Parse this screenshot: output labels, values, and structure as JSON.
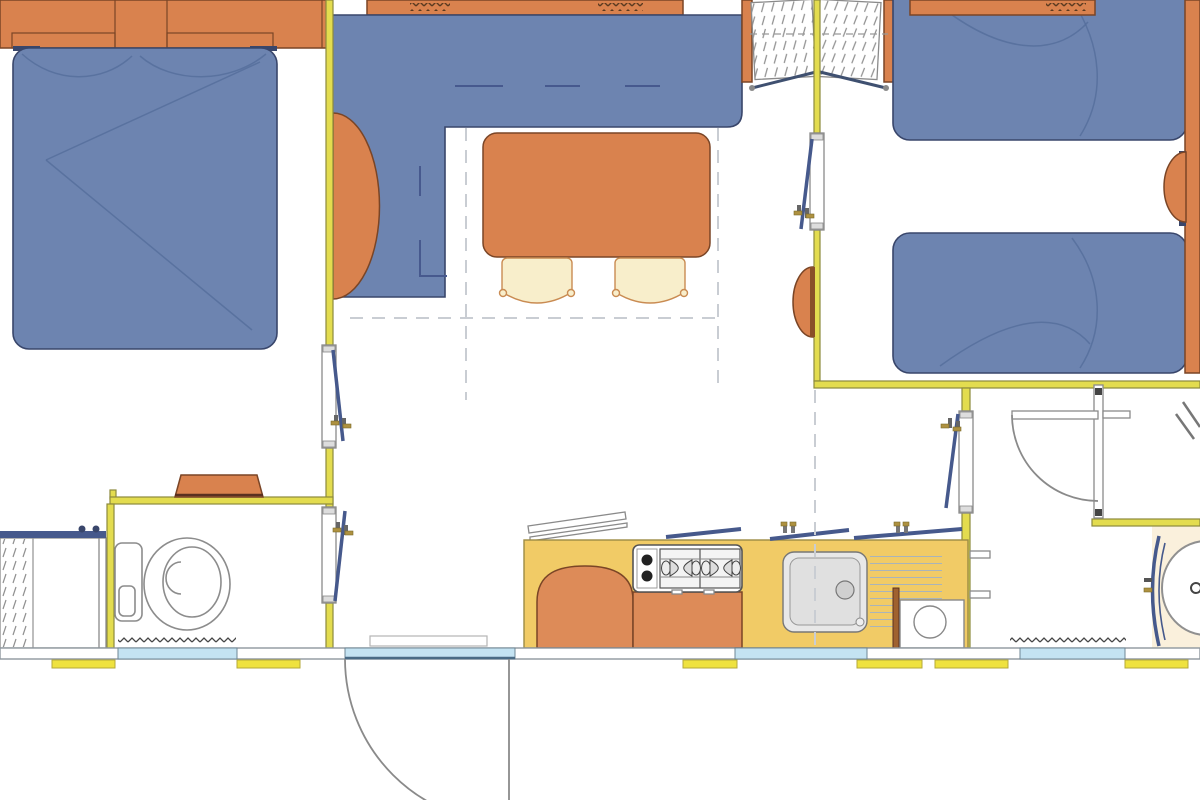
{
  "document": {
    "type": "floor-plan",
    "subject": "mobile-home interior layout, top-down architectural drawing",
    "visible_text": []
  },
  "colors": {
    "bg": "#FFFFFF",
    "wall": "#E3DC4F",
    "wall-edge": "#8D8A3C",
    "blue": "#6D84B0",
    "blue-edge": "#39466B",
    "crease": "#566E9C",
    "orange": "#D9824E",
    "orange-edge": "#7A4526",
    "korange": "#DD8B58",
    "counter": "#F1CB66",
    "counter-edge": "#9C8B45",
    "cream": "#FAF0DC",
    "glass": "#C4E3F2",
    "glass-edge": "#6F8795",
    "sill": "#EFE23F",
    "sill-edge": "#B5A93A",
    "sash": "#46598C",
    "brass": "#AE9140",
    "dash": "#C9CDD3",
    "gray": "#8E979E",
    "fixture": "#8C8C8C",
    "chair": "#F8EECB",
    "chair-edge": "#C98B52",
    "wood": "#A0622F"
  },
  "rooms": {
    "master_bedroom": {
      "furniture": [
        "overhead-cabinets",
        "double-bed"
      ]
    },
    "living_area": {
      "furniture": [
        "corner-sofa",
        "sofa-side-table",
        "dining-table",
        "chair",
        "chair",
        "double-wardrobe"
      ]
    },
    "twin_bedroom": {
      "furniture": [
        "single-bed",
        "single-bed",
        "fold-table",
        "headboard-shelf",
        "overhead-shelf"
      ]
    },
    "wc_room": {
      "furniture": [
        "toilet",
        "shelf",
        "doormat"
      ]
    },
    "shower_cabin": {
      "furniture": [
        "sliding-glass-door"
      ]
    },
    "kitchen": {
      "furniture": [
        "counter",
        "fridge",
        "gas-hob",
        "sink-with-drainer",
        "appliance",
        "worktop-flap"
      ]
    },
    "bathroom": {
      "furniture": [
        "round-shower",
        "curved-shower-door",
        "doormat"
      ]
    },
    "openings": [
      "casement-windows",
      "entrance-door",
      "interior-door",
      "sliding-thresholds"
    ]
  }
}
